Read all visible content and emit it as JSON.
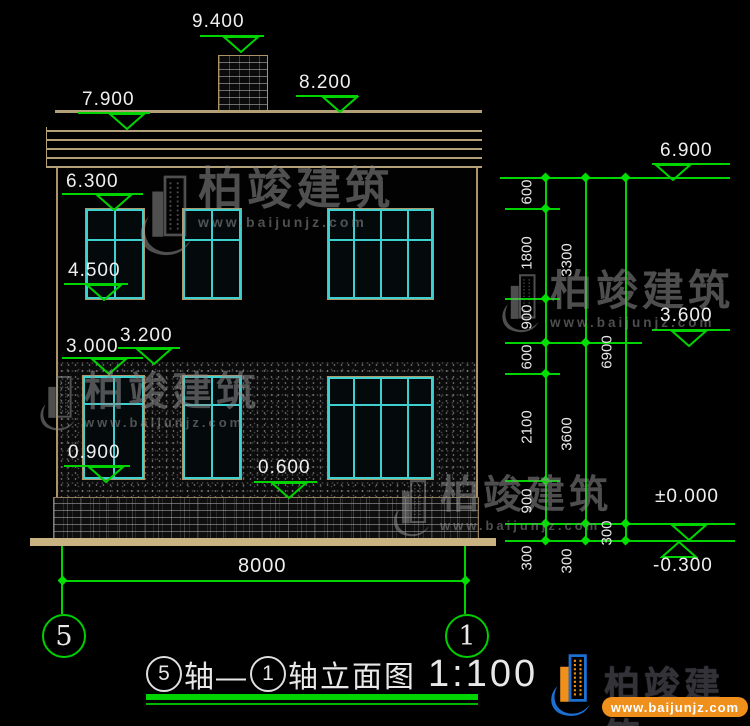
{
  "drawing": {
    "markers": [
      {
        "label": "9.400"
      },
      {
        "label": "8.200"
      },
      {
        "label": "7.900"
      },
      {
        "label": "6.300"
      },
      {
        "label": "4.500"
      },
      {
        "label": "3.200"
      },
      {
        "label": "3.000"
      },
      {
        "label": "0.900"
      },
      {
        "label": "0.600"
      },
      {
        "label": "6.900"
      },
      {
        "label": "3.600"
      },
      {
        "label": "±0.000"
      },
      {
        "label": "-0.300"
      }
    ],
    "chains": {
      "inner": [
        "600",
        "1800",
        "900",
        "600",
        "2100",
        "900",
        "300"
      ],
      "middle": [
        "3300",
        "3600",
        "300"
      ],
      "outer": [
        "6900",
        "300"
      ]
    },
    "width_dim": "8000",
    "axis_bubbles": [
      "5",
      "1"
    ]
  },
  "title_bar": {
    "axis_start": "5",
    "axis_mid": "轴—",
    "axis_end": "1",
    "axis_suffix": "轴立面图",
    "scale": "1:100"
  },
  "watermark": {
    "brand": "柏竣建筑",
    "url": "www.baijunjz.com"
  },
  "logo": {
    "brand": "柏竣建筑",
    "url": "www.baijunjz.com"
  },
  "colors": {
    "dim_green": "#00d400",
    "frame_tan": "#b3a077",
    "window_cyan": "#3ecfcf",
    "ground_tan": "#c9b383",
    "logo_orange": "#ef8f1c",
    "logo_blue": "#1d6fd1"
  }
}
